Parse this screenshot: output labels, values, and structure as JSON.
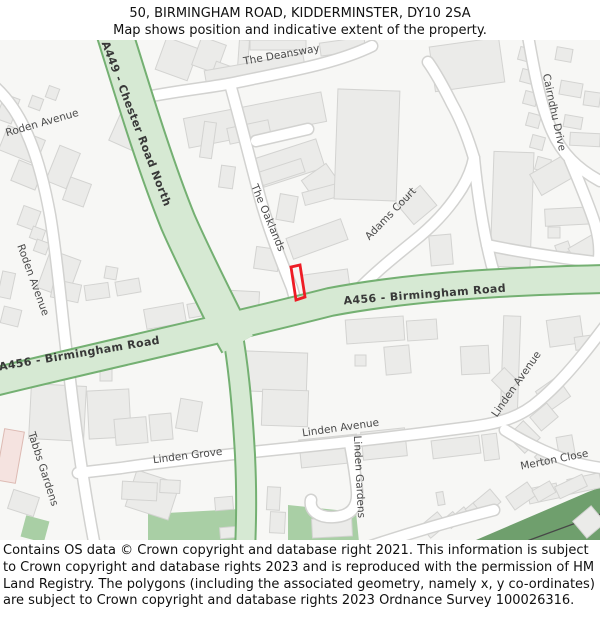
{
  "header": {
    "title": "50, BIRMINGHAM ROAD, KIDDERMINSTER, DY10 2SA",
    "subtitle": "Map shows position and indicative extent of the property."
  },
  "map": {
    "road_labels": [
      {
        "name": "a449-chester-road-north",
        "text": "A449 - Chester Road North"
      },
      {
        "name": "a456-birmingham-road-west",
        "text": "A456 - Birmingham Road"
      },
      {
        "name": "a456-birmingham-road-east",
        "text": "A456 - Birmingham Road"
      },
      {
        "name": "the-deansway",
        "text": "The Deansway"
      },
      {
        "name": "roden-avenue-north",
        "text": "Roden Avenue"
      },
      {
        "name": "roden-avenue-west",
        "text": "Roden Avenue"
      },
      {
        "name": "the-oaklands",
        "text": "The Oaklands"
      },
      {
        "name": "adams-court",
        "text": "Adams Court"
      },
      {
        "name": "cairndhu-drive",
        "text": "Cairndhu Drive"
      },
      {
        "name": "linden-avenue-main",
        "text": "Linden Avenue"
      },
      {
        "name": "linden-avenue-northeast",
        "text": "Linden Avenue"
      },
      {
        "name": "linden-grove",
        "text": "Linden Grove"
      },
      {
        "name": "linden-gardens",
        "text": "Linden Gardens"
      },
      {
        "name": "merton-close",
        "text": "Merton Close"
      },
      {
        "name": "tabbs-gardens",
        "text": "Tabbs Gardens"
      }
    ],
    "colors": {
      "background": "#f7f7f5",
      "a_road_fill": "#d6e9d3",
      "a_road_border": "#74b072",
      "street_fill": "#ffffff",
      "street_border": "#d2d2d0",
      "building_fill": "#ebebe9",
      "building_border": "#d3d3d1",
      "greenspace": "#a9cfa5",
      "woodland": "#6f9f6d",
      "property_outline": "#ee1c25"
    }
  },
  "footer": {
    "text": "Contains OS data © Crown copyright and database right 2021. This information is subject to Crown copyright and database rights 2023 and is reproduced with the permission of HM Land Registry. The polygons (including the associated geometry, namely x, y co-ordinates) are subject to Crown copyright and database rights 2023 Ordnance Survey 100026316."
  }
}
